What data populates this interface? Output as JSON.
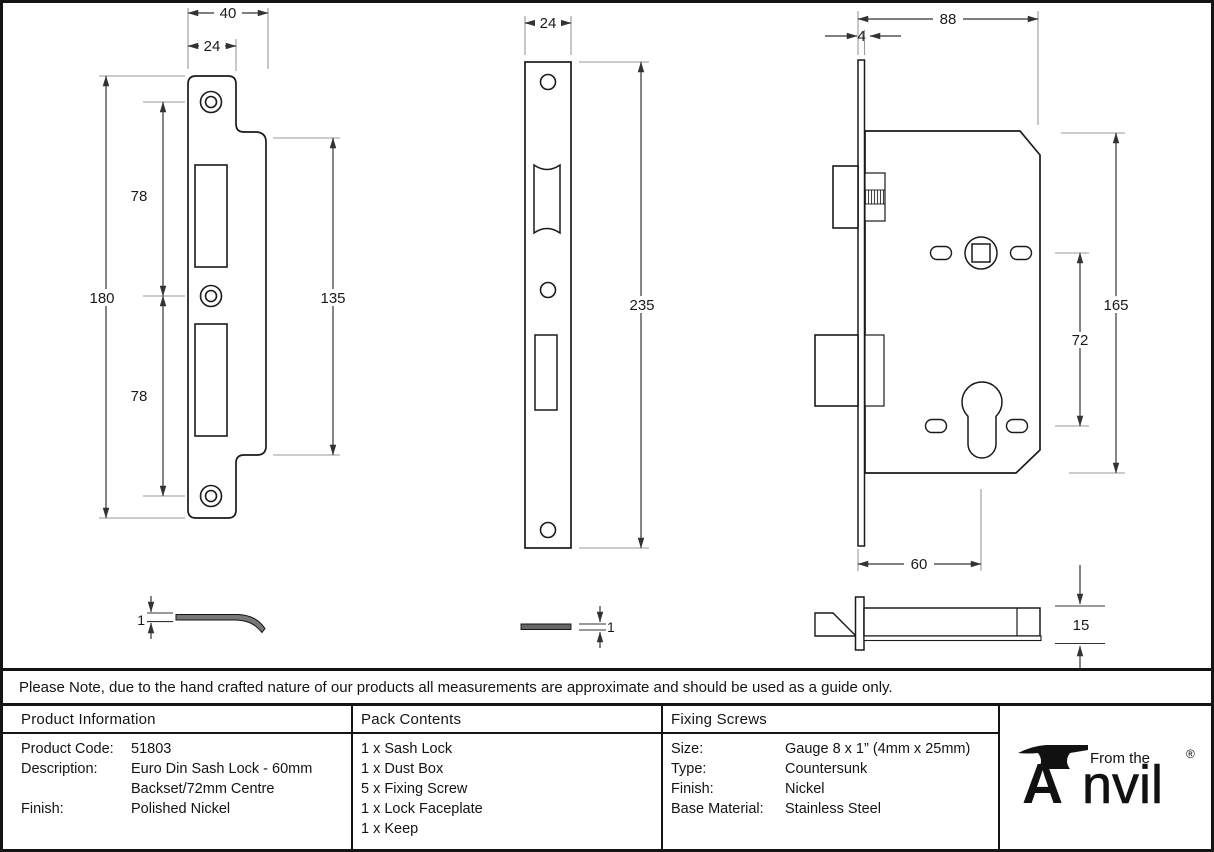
{
  "note": "Please Note, due to the hand crafted nature of our products all measurements are approximate and should be used as a guide only.",
  "dims": {
    "keep": {
      "w_outer": "40",
      "w_inner": "24",
      "h_outer": "180",
      "seg_top": "78",
      "seg_bottom": "78",
      "h_wide": "135",
      "thickness": "1"
    },
    "faceplate": {
      "w": "24",
      "h": "235",
      "thickness": "1"
    },
    "lock": {
      "depth": "88",
      "plate_t": "4",
      "case_h": "165",
      "centres": "72",
      "backset": "60",
      "case_t": "15"
    }
  },
  "table": {
    "col1": {
      "header": "Product Information",
      "rows": [
        {
          "label": "Product Code:",
          "value": "51803"
        },
        {
          "label": "Description:",
          "value": "Euro Din Sash Lock - 60mm"
        },
        {
          "label": "",
          "value": "Backset/72mm Centre"
        },
        {
          "label": "Finish:",
          "value": "Polished Nickel"
        }
      ]
    },
    "col2": {
      "header": "Pack Contents",
      "items": [
        "1 x Sash Lock",
        "1 x Dust Box",
        "5 x Fixing Screw",
        "1 x Lock Faceplate",
        "1 x Keep"
      ]
    },
    "col3": {
      "header": "Fixing Screws",
      "rows": [
        {
          "label": "Size:",
          "value": "Gauge 8 x 1” (4mm x 25mm)"
        },
        {
          "label": "Type:",
          "value": "Countersunk"
        },
        {
          "label": "Finish:",
          "value": "Nickel"
        },
        {
          "label": "Base Material:",
          "value": "Stainless Steel"
        }
      ]
    }
  },
  "logo": {
    "tagline": "From the",
    "brand_a": "A",
    "brand_rest": "nvil",
    "registered": "®"
  }
}
